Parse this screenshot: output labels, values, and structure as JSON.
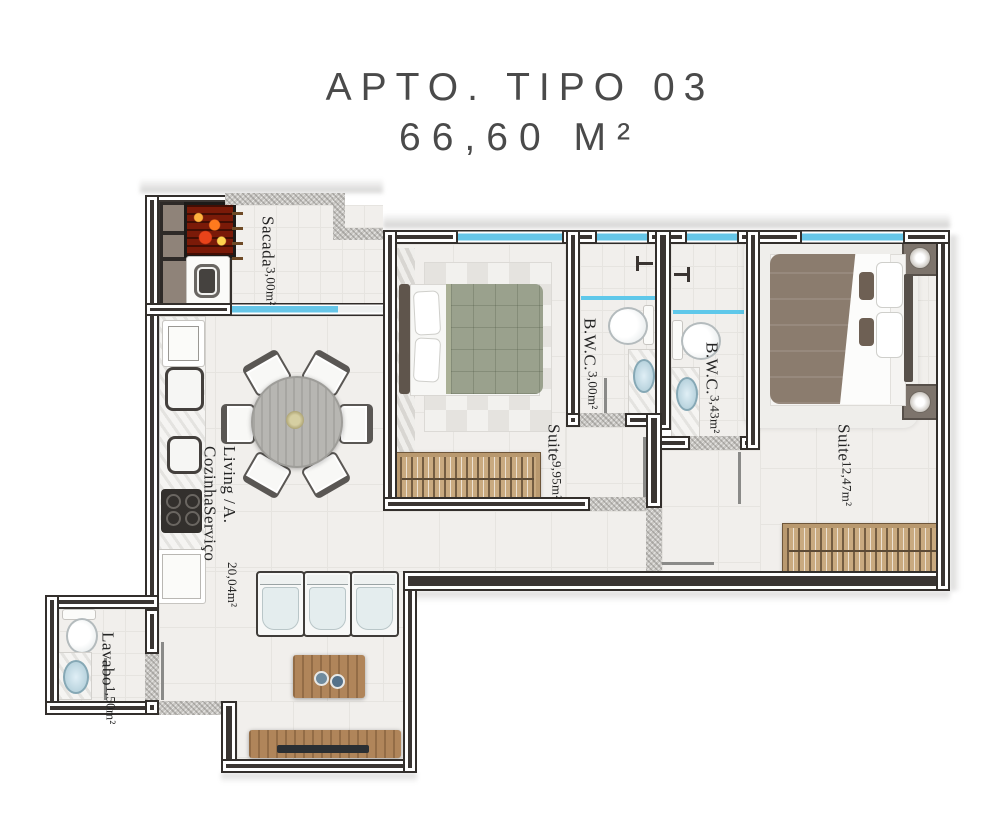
{
  "title": {
    "line1": "Apto. Tipo 03",
    "line2": "66,60 m²"
  },
  "rooms": {
    "sacada": {
      "name": "Sacada",
      "area": "3,00m²"
    },
    "living": {
      "line1": "Living / Cozinha",
      "line2": "A. Serviço",
      "area": "20,04m²"
    },
    "suite1": {
      "name": "Suite",
      "area": "9,95m²"
    },
    "bwc1": {
      "name": "B.W.C.",
      "area": "3,00m²"
    },
    "bwc2": {
      "name": "B.W.C.",
      "area": "3,43m²"
    },
    "suite2": {
      "name": "Suite",
      "area": "12,47m²"
    },
    "lavabo": {
      "name": "Lavabo",
      "area": "1,50m²"
    }
  },
  "colors": {
    "wall": "#3a3532",
    "window_glass": "#66c6e8",
    "floor": "#f1efec",
    "concrete": "#c9c7c3",
    "wood": "#b0855a",
    "duvet_suite1": "#9aa18d",
    "duvet_suite2": "#8b7c6e",
    "title_text": "#4a4a4a"
  }
}
